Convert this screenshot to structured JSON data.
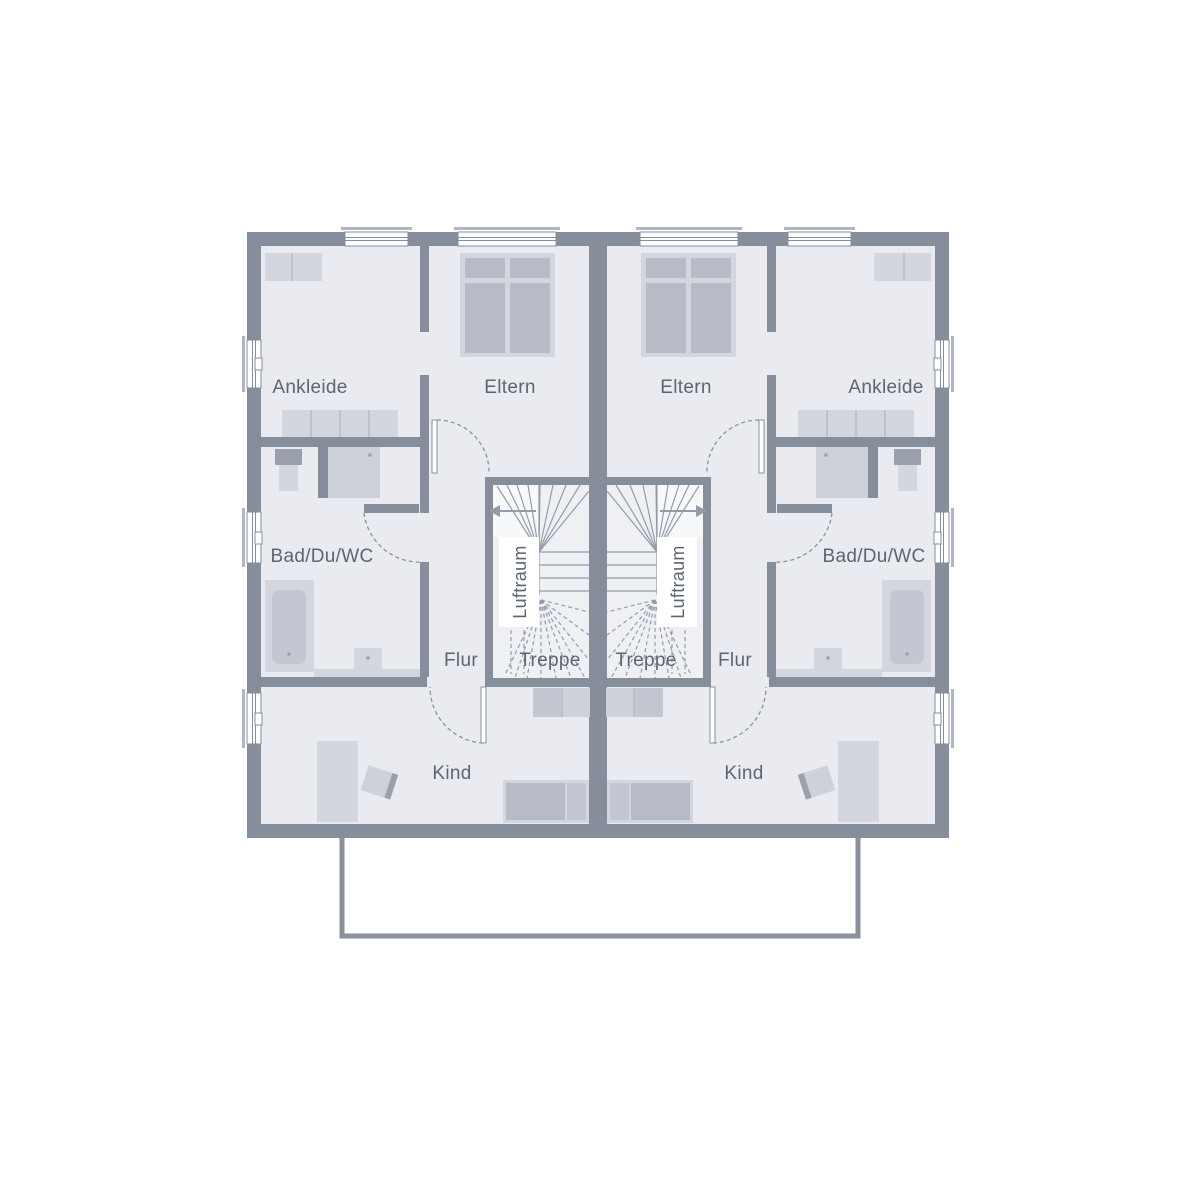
{
  "plan_type": "floor-plan",
  "labels": {
    "ankleide": "Ankleide",
    "eltern": "Eltern",
    "bad": "Bad/Du/WC",
    "flur": "Flur",
    "treppe": "Treppe",
    "kind": "Kind",
    "luftraum": "Luftraum"
  },
  "units": [
    {
      "side": "left",
      "rooms": [
        "Ankleide",
        "Eltern",
        "Bad/Du/WC",
        "Flur",
        "Treppe",
        "Kind",
        "Luftraum"
      ]
    },
    {
      "side": "right",
      "rooms": [
        "Eltern",
        "Ankleide",
        "Bad/Du/WC",
        "Flur",
        "Treppe",
        "Kind",
        "Luftraum"
      ]
    }
  ],
  "colors": {
    "background": "#ffffff",
    "wall": "#868d9b",
    "floor": "#e9ebf0",
    "stair_floor": "#eef0f4",
    "landing": "#f7f8fa",
    "window_white": "#ffffff",
    "lintel": "#b0b5bf",
    "furniture_light": "#d3d6de",
    "furniture_medium": "#b6bbc6",
    "furniture_dark": "#9aa0ac",
    "fixture": "#cdd1d9",
    "fixture_2": "#c3c7d1",
    "tread_line": "#959baa",
    "door_arc": "#8a919d",
    "outline": "#8a919d",
    "label_text": "#5d6472"
  }
}
